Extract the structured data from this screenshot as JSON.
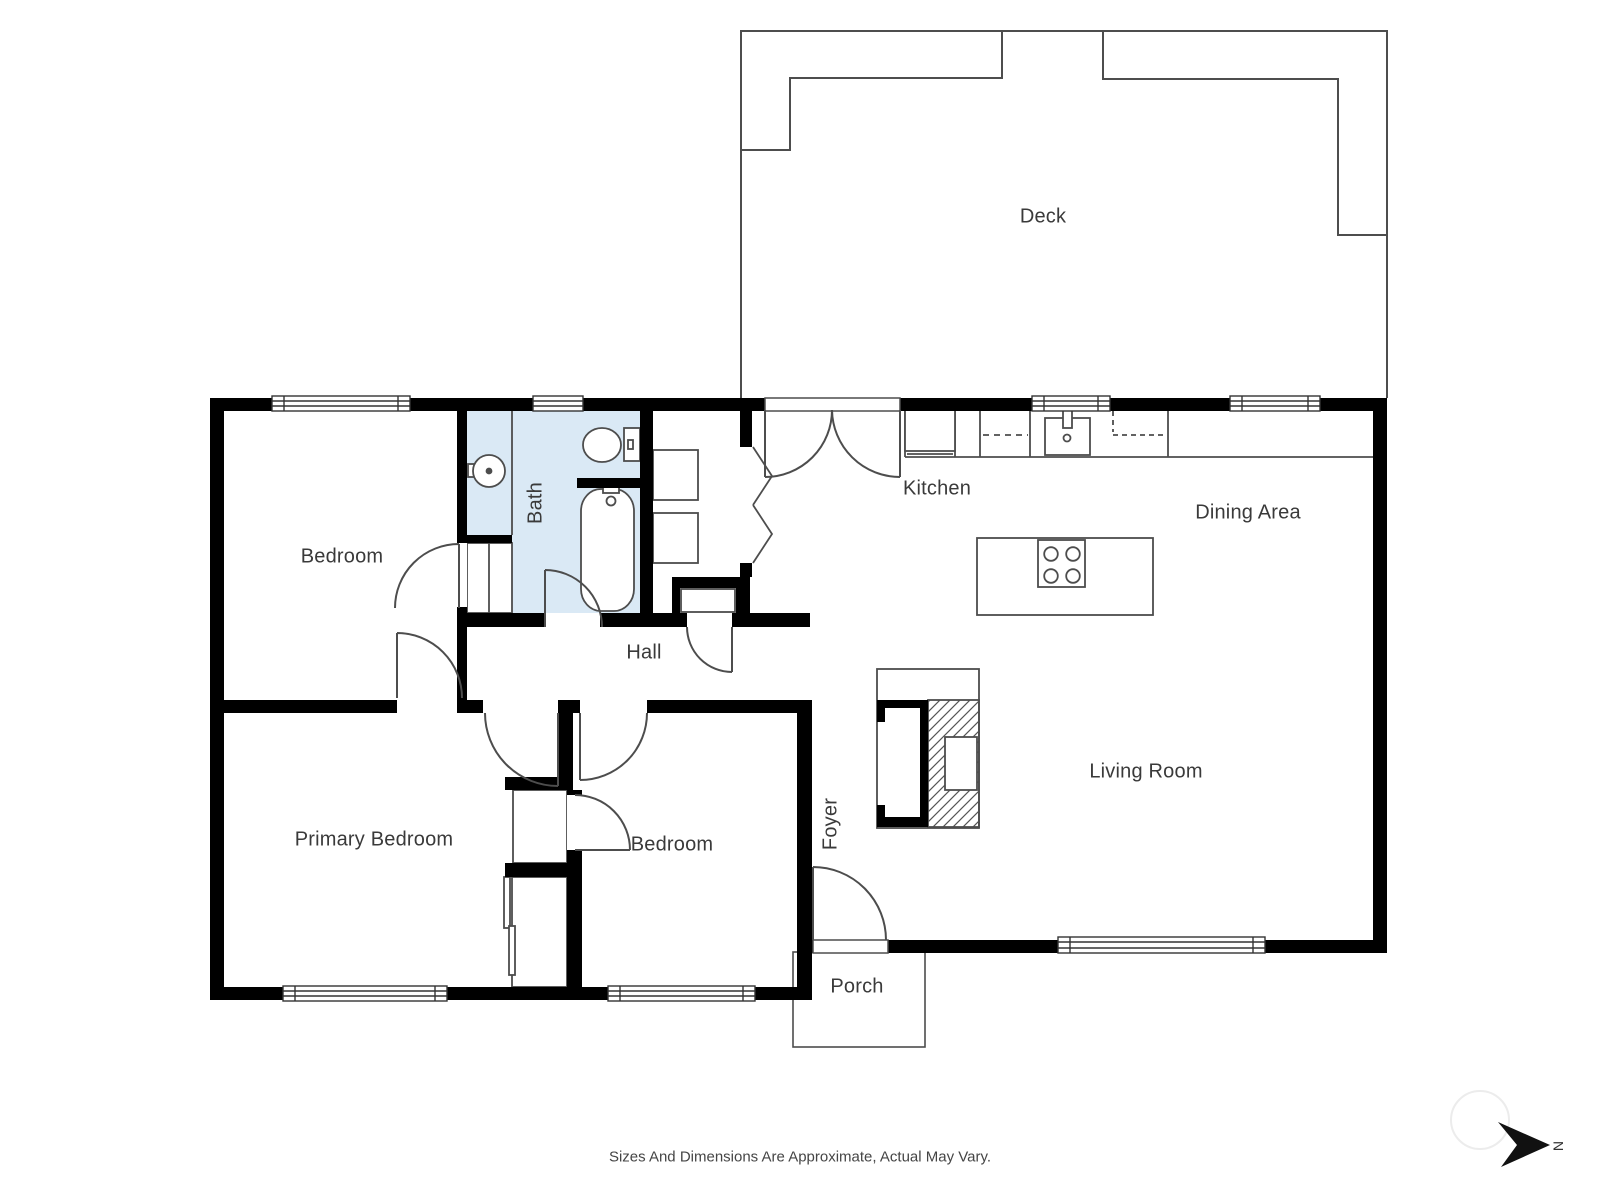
{
  "rooms": {
    "deck": "Deck",
    "kitchen": "Kitchen",
    "dining_area": "Dining Area",
    "bath": "Bath",
    "bedroom_top": "Bedroom",
    "hall": "Hall",
    "primary_bedroom": "Primary Bedroom",
    "bedroom_bottom": "Bedroom",
    "foyer": "Foyer",
    "living_room": "Living Room",
    "porch": "Porch"
  },
  "footer": {
    "disclaimer": "Sizes And Dimensions Are Approximate, Actual May Vary."
  },
  "compass": {
    "north_label": "N"
  },
  "colors": {
    "wall": "#000000",
    "line": "#4d4d4d",
    "bath_fill": "#dae9f5",
    "label_text": "#3a3a3a"
  }
}
